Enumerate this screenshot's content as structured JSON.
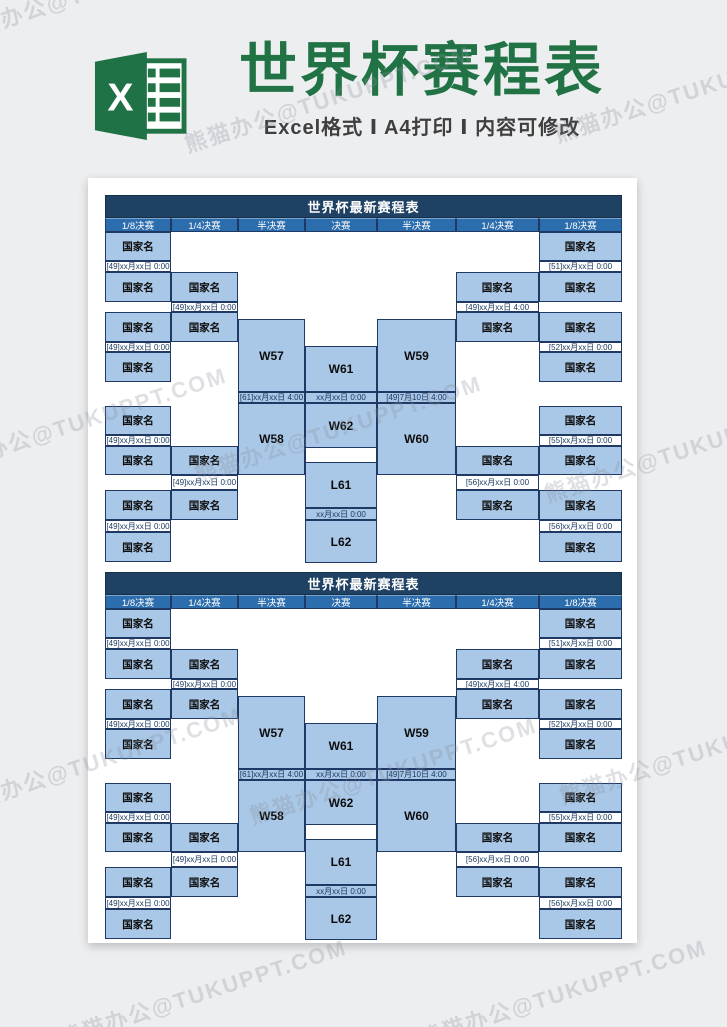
{
  "page": {
    "background": "#edeef0",
    "watermark": "熊猫办公@TUKUPPT.COM"
  },
  "banner": {
    "title": "世界杯赛程表",
    "subtitle": "Excel格式 Ⅰ A4打印 Ⅰ 内容可修改",
    "title_color": "#217346",
    "icon": "excel-logo",
    "icon_letter": "X"
  },
  "bracket": {
    "title": "世界杯最新赛程表",
    "columns": [
      "1/8决赛",
      "1/4决赛",
      "半决赛",
      "决赛",
      "半决赛",
      "1/4决赛",
      "1/8决赛"
    ],
    "country_placeholder": "国家名",
    "left": {
      "r16_dates": [
        "[49]xx月xx日 0:00",
        "[49]xx月xx日 0:00",
        "[49]xx月xx日 0:00",
        "[49]xx月xx日 0:00"
      ],
      "qf_dates": [
        "[49]xx月xx日 0:00",
        "[49]xx月xx日 0:00"
      ],
      "sf": {
        "top": "W57",
        "date": "[61]xx月xx日 4:00",
        "bottom": "W58"
      }
    },
    "final": {
      "top": "W61",
      "date": "xx月xx日 0:00",
      "bottom": "W62"
    },
    "third_place": {
      "top": "L61",
      "date": "xx月xx日 0:00",
      "bottom": "L62"
    },
    "right": {
      "r16_dates": [
        "[51]xx月xx日 0:00",
        "[52]xx月xx日 0:00",
        "[55]xx月xx日 0:00",
        "[56]xx月xx日 0:00"
      ],
      "qf_dates": [
        "[49]xx月xx日 4:00",
        "[56]xx月xx日 0:00"
      ],
      "sf": {
        "top": "W59",
        "date": "[49]7月10日 4:00",
        "bottom": "W60"
      }
    },
    "colors": {
      "title_bar": "#1E4164",
      "header_row": "#2C6DAD",
      "cell_fill": "#A9C7E7",
      "border": "#1F3864"
    }
  }
}
